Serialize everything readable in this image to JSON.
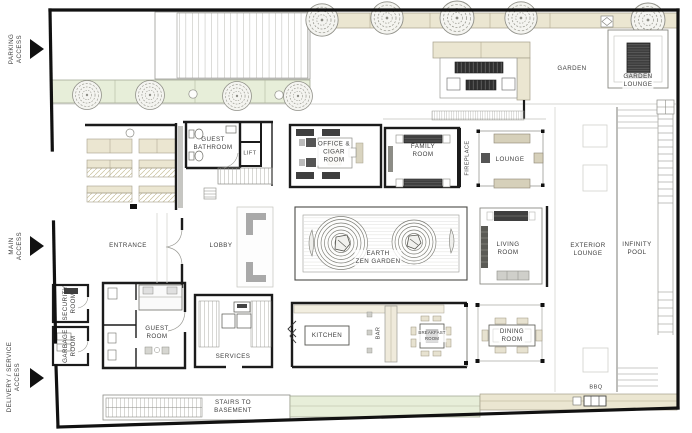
{
  "access": {
    "parking": "PARKING\nACCESS",
    "main": "MAIN\nACCESS",
    "delivery": "DELIVERY / SERVICE\nACCESS"
  },
  "rooms": {
    "garden": "GARDEN",
    "garden_lounge": "GARDEN\nLOUNGE",
    "guest_bathroom": "GUEST\nBATHROOM",
    "lift": "LIFT",
    "office_cigar_room": "OFFICE &\nCIGAR\nROOM",
    "family_room": "FAMILY\nROOM",
    "fireplace": "FIREPLACE",
    "lounge": "LOUNGE",
    "entrance": "ENTRANCE",
    "lobby": "LOBBY",
    "earth_zen_garden": "EARTH\nZEN GARDEN",
    "living_room": "LIVING\nROOM",
    "exterior_lounge": "EXTERIOR\nLOUNGE",
    "infinity_pool": "INFINITY\nPOOL",
    "security_room": "SECURITY\nROOM",
    "garbage_room": "GARBAGE\nROOM",
    "guest_room": "GUEST\nROOM",
    "services": "SERVICES",
    "kitchen": "KITCHEN",
    "bar": "BAR",
    "breakfast_room": "BREAKFAST\nROOM",
    "dining_room": "DINING\nROOM",
    "stairs_to_basement": "STAIRS TO\nBASEMENT",
    "bbq": "BBQ"
  },
  "colors": {
    "wall": "#1b1b1b",
    "planter_beige": "#ebe6d1",
    "grass_green": "#e7eed9",
    "line_gray": "#8c8c8c",
    "rug_dark": "#3e3e3e",
    "background": "#ffffff"
  }
}
